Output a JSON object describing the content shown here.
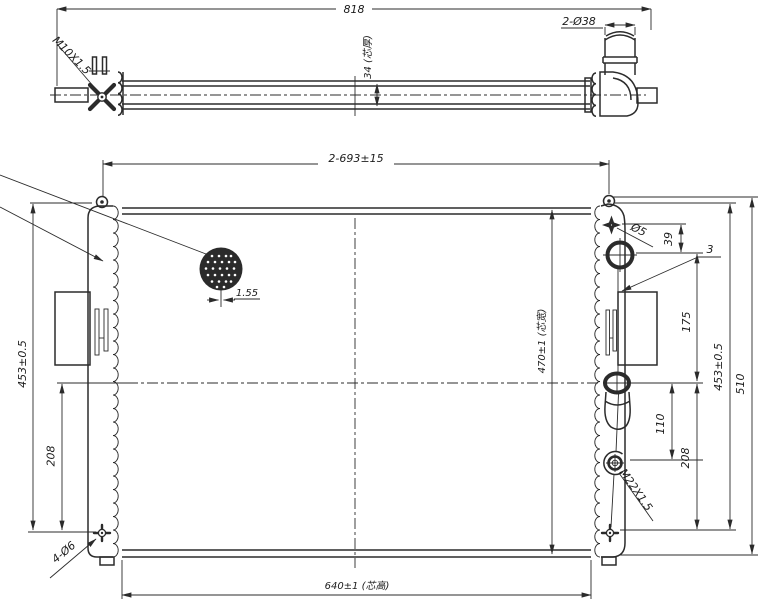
{
  "colors": {
    "line": "#2b2b2b",
    "text": "#1c1c1c",
    "background": "#ffffff"
  },
  "top_view": {
    "overall_length": "818",
    "pipe_ports": "2-Ø38",
    "core_thickness": "34 (芯厚)",
    "fitting_thread": "M10X1.5"
  },
  "front_view": {
    "pin_span": "2-693±15",
    "fin_pitch": "1.55",
    "height_left": "453±0.5",
    "center_to_bottom_left": "208",
    "core_width": "470±1 (芯宽)",
    "core_height": "640±1 (芯高)",
    "bleed_hole": "Ø5",
    "bleed_to_filler": "39",
    "bracket_thickness": "3",
    "filler_to_center": "175",
    "center_to_drain": "110",
    "center_to_bottom_right": "208",
    "height_right": "453±0.5",
    "overall_height": "510",
    "drain_thread": "M22X1.5",
    "mount_holes": "4-Ø6"
  }
}
